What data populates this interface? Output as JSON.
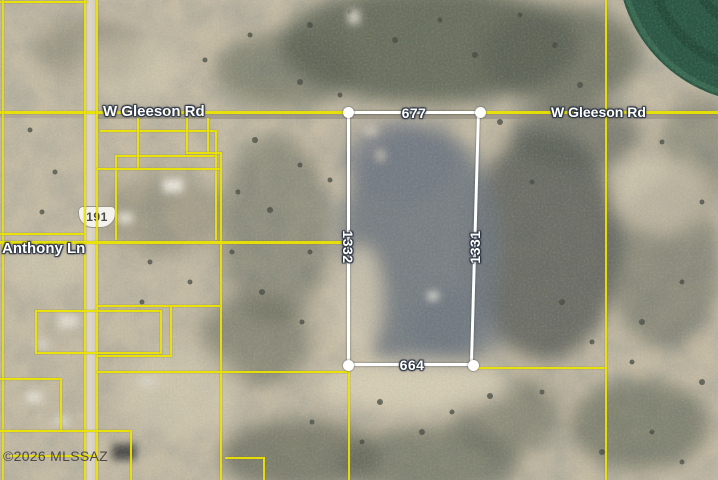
{
  "map": {
    "description": "Aerial MLS parcel map at W Gleeson Rd and US-191",
    "labels": {
      "road_gleeson_left": "W Gleeson Rd",
      "road_gleeson_right": "W Gleeson Rd",
      "road_anthony": "Anthony Ln",
      "highway_shield": "191"
    },
    "parcel_dimensions": {
      "top": "677",
      "bottom": "664",
      "left": "1332",
      "right": "1331"
    },
    "copyright": "©2026 MLSSAZ",
    "colors": {
      "parcel_outline": "#ffffff",
      "boundary_lines": "#ece400",
      "irrigated_field_green": "#265441",
      "desert_base": "#c7bda6"
    }
  }
}
